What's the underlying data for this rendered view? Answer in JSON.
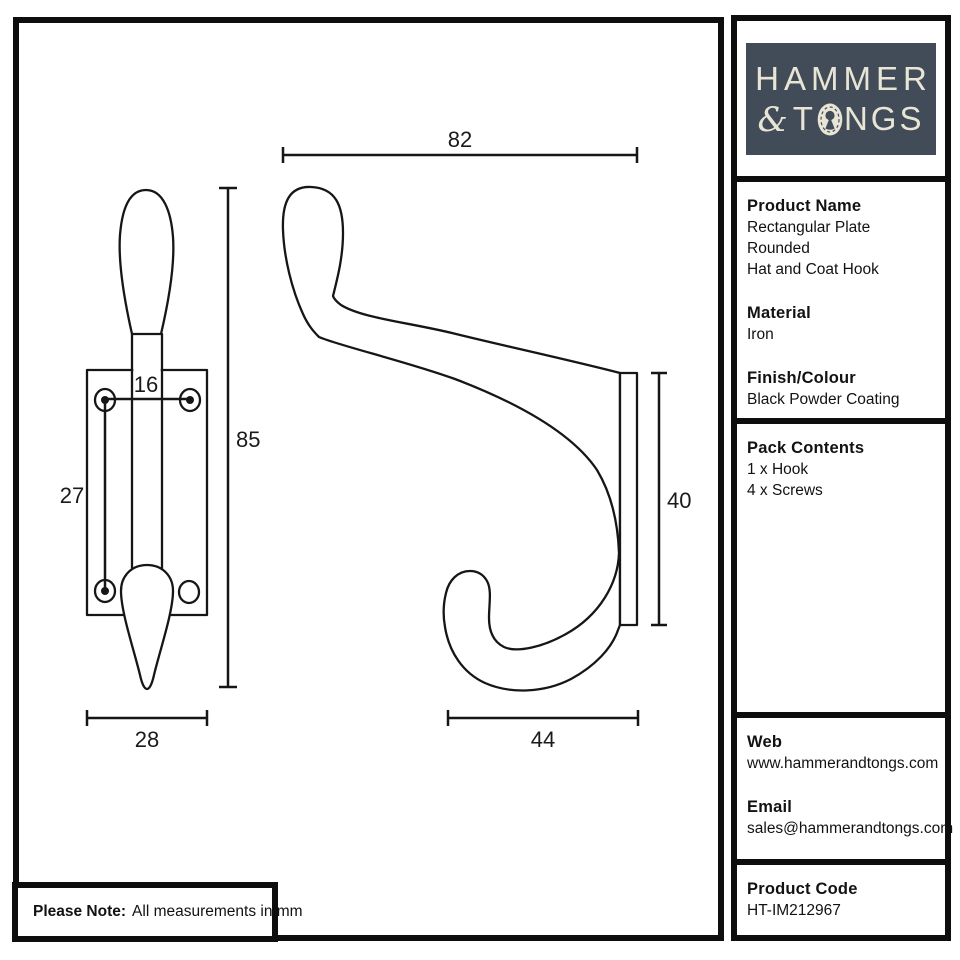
{
  "brand": {
    "word1": "HAMMER",
    "amp": "&",
    "word2a": "T",
    "word2b": "NGS"
  },
  "colors": {
    "logo_bg": "#424b58",
    "logo_fg": "#e9e5d6",
    "line": "#161616"
  },
  "sidebar": {
    "product_name": {
      "heading": "Product Name",
      "line1": "Rectangular Plate Rounded",
      "line2": "Hat and Coat Hook"
    },
    "material": {
      "heading": "Material",
      "value": "Iron"
    },
    "finish": {
      "heading": "Finish/Colour",
      "value": "Black Powder Coating"
    },
    "pack": {
      "heading": "Pack Contents",
      "item1": "1 x Hook",
      "item2": "4 x Screws"
    },
    "web": {
      "heading": "Web",
      "value": "www.hammerandtongs.com"
    },
    "email": {
      "heading": "Email",
      "value": "sales@hammerandtongs.com"
    },
    "code": {
      "heading": "Product Code",
      "value": "HT-IM212967"
    }
  },
  "note": {
    "bold": "Please Note:",
    "text": "All measurements in mm"
  },
  "drawing": {
    "units": "mm",
    "dims": {
      "hole_spacing": "16",
      "hole_vertical": "27",
      "front_height": "85",
      "front_width": "28",
      "side_depth": "82",
      "plate_height": "40",
      "hook_reach": "44"
    }
  }
}
